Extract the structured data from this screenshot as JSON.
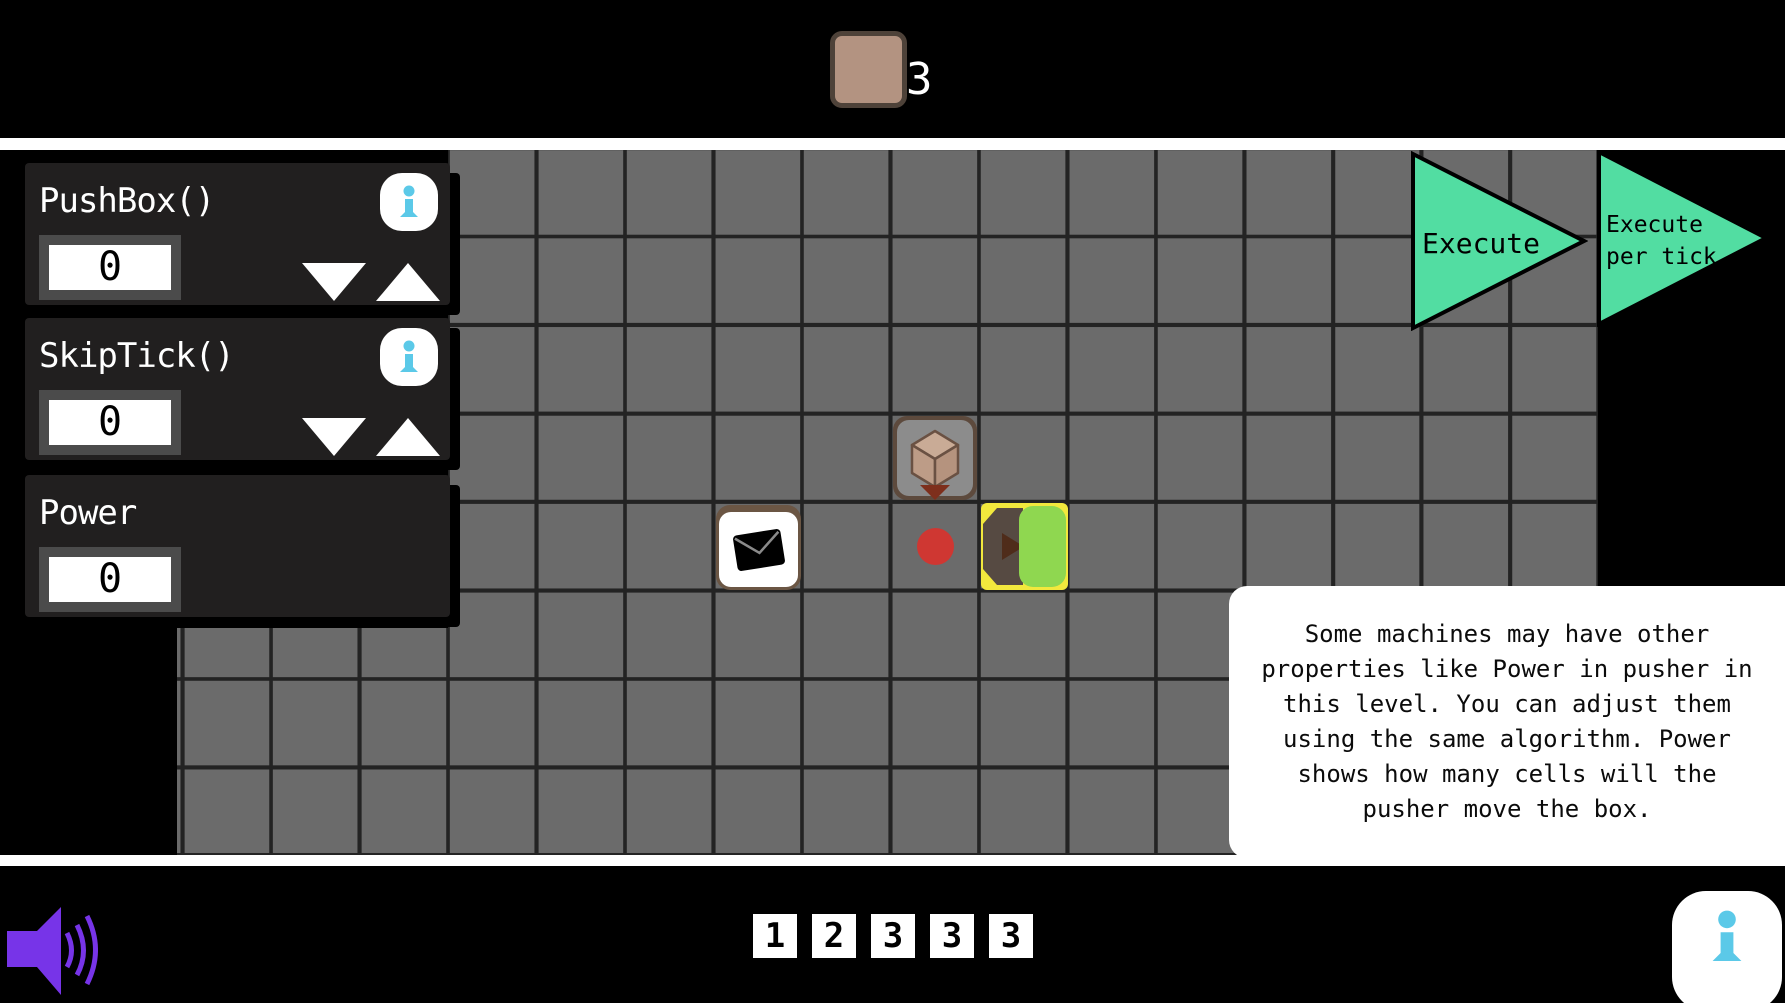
{
  "top_bar": {
    "box_count": "3"
  },
  "controls": {
    "items": [
      {
        "label": "PushBox()",
        "value": "0"
      },
      {
        "label": "SkipTick()",
        "value": "0"
      },
      {
        "label": "Power",
        "value": "0"
      }
    ]
  },
  "execute": {
    "run_label": "Execute",
    "per_tick_label": "Execute\nper tick"
  },
  "tutorial": {
    "text": "Some machines may have other properties like Power in pusher in this level. You can adjust them using the same algorithm. Power shows how many cells will the pusher move the box."
  },
  "footer": {
    "levels": [
      "1",
      "2",
      "3",
      "3",
      "3"
    ]
  },
  "icons": {
    "box_counter": "crate-icon",
    "spawner": "cube-spawner-icon",
    "envelope": "envelope-icon",
    "pusher": "pusher-machine-icon",
    "speaker": "speaker-icon",
    "info": "info-icon"
  },
  "colors": {
    "accent_cyan": "#5bc9e8",
    "execute_green": "#52dda2",
    "speaker_purple": "#7734e8",
    "crate_tan": "#b39381",
    "pusher_yellow": "#f2e83d",
    "pusher_green": "#8fd750",
    "red_dot": "#cf3732",
    "grid_gray": "#6b6b6b",
    "panel_dark": "#211f1f"
  }
}
